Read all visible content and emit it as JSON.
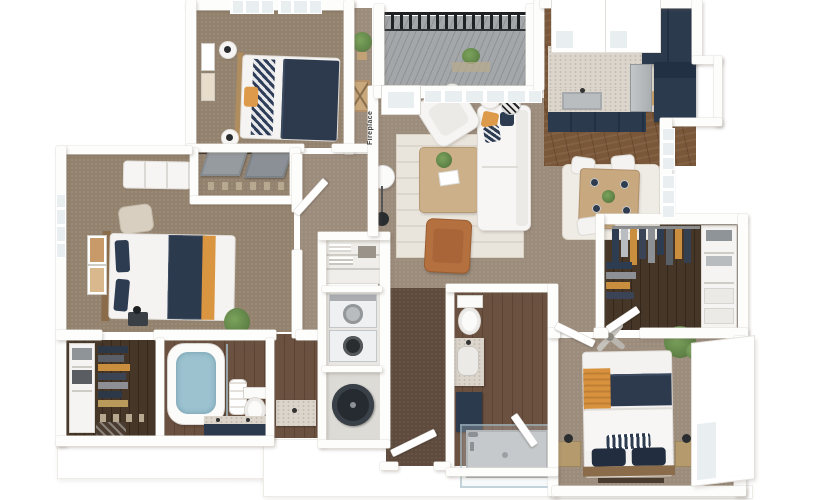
{
  "scene": {
    "description": "3D dollhouse-view apartment floor plan rendering on white background",
    "background": "#ffffff"
  },
  "labels": {
    "fireplace": "Fireplace"
  },
  "palette": {
    "wall_white": "#ffffff",
    "carpet_bedroom": "#93826e",
    "carpet_living": "#9c8c7c",
    "carpet_hall_dark": "#5e4b3d",
    "hardwood_kitchen": "#7a5739",
    "hardwood_bath": "#6b5140",
    "hardwood_closet_dark": "#453627",
    "cabinet_navy": "#2c3a4e",
    "accent_orange": "#d8953f",
    "leather_cognac": "#b4713f",
    "marble_counter": "#dbd5cc",
    "deck_gray": "#9a9da0",
    "railing_black": "#202325",
    "window_glass": "#e9eef1",
    "plant_green": "#6d9155",
    "bath_water_blue": "#9cc2d0",
    "rug_cream": "#eae5dc"
  },
  "rooms": [
    {
      "id": "bedroom-1",
      "name": "Bedroom 1",
      "floor": "carpet",
      "furniture": [
        "bed-navy-orange",
        "round-nightstands",
        "wall-art",
        "reach-in-closet",
        "windows"
      ]
    },
    {
      "id": "balcony",
      "name": "Balcony",
      "floor": "wood-deck",
      "furniture": [
        "black-railing",
        "potted-plant"
      ]
    },
    {
      "id": "kitchen",
      "name": "Kitchen",
      "floor": "hardwood",
      "furniture": [
        "sink",
        "marble-counters",
        "navy-cabinets",
        "stainless-appliance",
        "windows",
        "cutting-board"
      ]
    },
    {
      "id": "living-room",
      "name": "Living Room",
      "floor": "carpet",
      "furniture": [
        "fireplace",
        "sofa",
        "accent-armchair",
        "leather-chair",
        "coffee-table",
        "area-rug",
        "arc-floor-lamp",
        "side-table",
        "pouf",
        "french-door",
        "windows",
        "plant",
        "console-table"
      ]
    },
    {
      "id": "dining-area",
      "name": "Dining Area",
      "floor": "carpet",
      "furniture": [
        "dining-table",
        "four-chairs",
        "place-settings",
        "centerpiece",
        "area-rug",
        "tall-windows"
      ]
    },
    {
      "id": "bedroom-2",
      "name": "Bedroom 2",
      "floor": "carpet",
      "furniture": [
        "bed-navy-orange",
        "dresser",
        "accent-chair",
        "wall-art",
        "nightstand",
        "plant",
        "window"
      ]
    },
    {
      "id": "bathroom-1",
      "name": "Bathroom 1",
      "floor": "hardwood",
      "furniture": [
        "freestanding-tub",
        "toilet",
        "navy-vanity",
        "towels",
        "glass-panel"
      ]
    },
    {
      "id": "vestibule",
      "name": "Vanity Nook",
      "floor": "hardwood",
      "furniture": [
        "marble-vanity"
      ]
    },
    {
      "id": "walk-in-closet-1",
      "name": "Walk-in Closet",
      "floor": "hardwood-dark",
      "furniture": [
        "hanging-clothes",
        "shelving-unit",
        "storage-bins"
      ]
    },
    {
      "id": "walk-in-closet-2",
      "name": "Walk-in Closet",
      "floor": "hardwood-dark",
      "furniture": [
        "hanging-clothes",
        "shelving",
        "baskets",
        "ottoman",
        "shoes"
      ]
    },
    {
      "id": "bathroom-2",
      "name": "Bathroom 2",
      "floor": "hardwood",
      "furniture": [
        "toilet",
        "marble-vanity",
        "glass-shower",
        "navy-hamper"
      ]
    },
    {
      "id": "utility-closets",
      "name": "Laundry / Utility Closets",
      "floor": "hardwood",
      "furniture": [
        "linen-shelves",
        "stacked-washer-dryer",
        "water-heater"
      ]
    },
    {
      "id": "hallway",
      "name": "Hallway",
      "floor": "carpet",
      "furniture": [
        "doors"
      ]
    },
    {
      "id": "entry",
      "name": "Entry",
      "floor": "carpet-dark",
      "furniture": [
        "entry-door"
      ]
    },
    {
      "id": "bedroom-3",
      "name": "Bedroom 3",
      "floor": "carpet",
      "furniture": [
        "bed-navy-orange",
        "nightstands",
        "wall-sconces",
        "ceiling-fan",
        "plant",
        "large-window",
        "foot-bench"
      ]
    }
  ]
}
